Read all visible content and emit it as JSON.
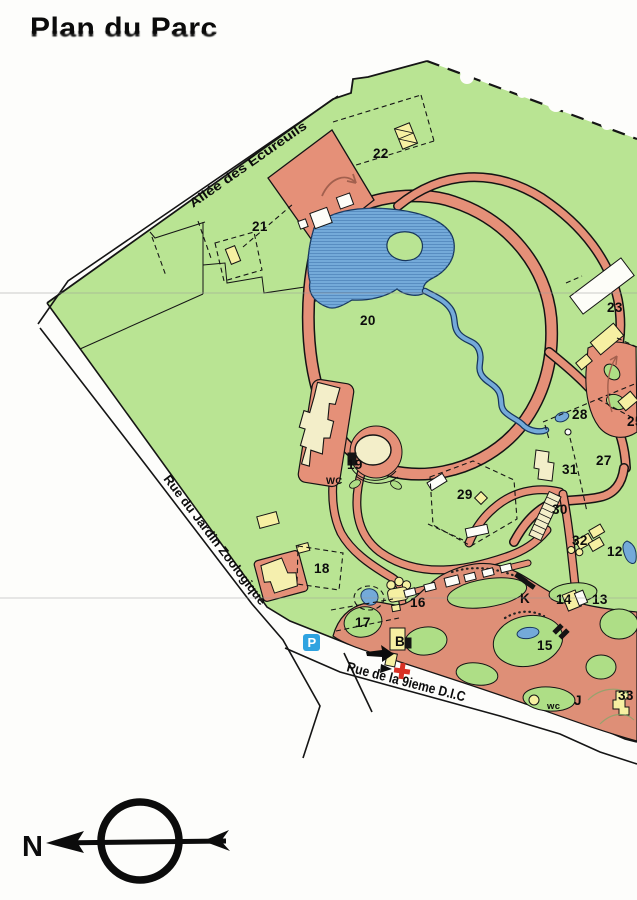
{
  "title": "Plan du Parc",
  "streets": [
    {
      "id": "allee",
      "name": "Allée des Ecureuils"
    },
    {
      "id": "jardin",
      "name": "Rue du Jardin Zoologique"
    },
    {
      "id": "dic",
      "name": "Rue de la 9ieme D.I.C"
    }
  ],
  "compass": {
    "north_label": "N"
  },
  "parking": {
    "label": "P"
  },
  "map_labels": [
    {
      "text": "13",
      "x": 592,
      "y": 604
    },
    {
      "text": "14",
      "x": 556,
      "y": 604
    },
    {
      "text": "15",
      "x": 537,
      "y": 650
    },
    {
      "text": "16",
      "x": 410,
      "y": 607
    },
    {
      "text": "17",
      "x": 355,
      "y": 627
    },
    {
      "text": "18",
      "x": 314,
      "y": 573
    },
    {
      "text": "19",
      "x": 347,
      "y": 469
    },
    {
      "text": "20",
      "x": 360,
      "y": 325
    },
    {
      "text": "21",
      "x": 252,
      "y": 231
    },
    {
      "text": "22",
      "x": 373,
      "y": 158
    },
    {
      "text": "23",
      "x": 607,
      "y": 312
    },
    {
      "text": "25",
      "x": 627,
      "y": 426
    },
    {
      "text": "27",
      "x": 596,
      "y": 465
    },
    {
      "text": "28",
      "x": 572,
      "y": 419
    },
    {
      "text": "29",
      "x": 457,
      "y": 499
    },
    {
      "text": "30",
      "x": 552,
      "y": 514
    },
    {
      "text": "31",
      "x": 562,
      "y": 474
    },
    {
      "text": "32",
      "x": 572,
      "y": 545
    },
    {
      "text": "33",
      "x": 618,
      "y": 700
    },
    {
      "text": "12",
      "x": 607,
      "y": 556
    },
    {
      "text": "J",
      "x": 574,
      "y": 705
    },
    {
      "text": "K",
      "x": 520,
      "y": 603
    },
    {
      "text": "B",
      "x": 395,
      "y": 646
    },
    {
      "text": "WC",
      "x": 326,
      "y": 484,
      "small": true
    },
    {
      "text": "wc",
      "x": 547,
      "y": 709,
      "small": true
    }
  ],
  "colors": {
    "park_green": "#b9e493",
    "island_green": "#aede86",
    "path_pink": "#e59078",
    "zone_pink": "#de8f77",
    "water_blue": "#74aad9",
    "building_yellow": "#f6f0a2",
    "building_cream": "#f3eec9",
    "parking_blue": "#2fa3e0",
    "first_aid_red": "#d93025"
  }
}
